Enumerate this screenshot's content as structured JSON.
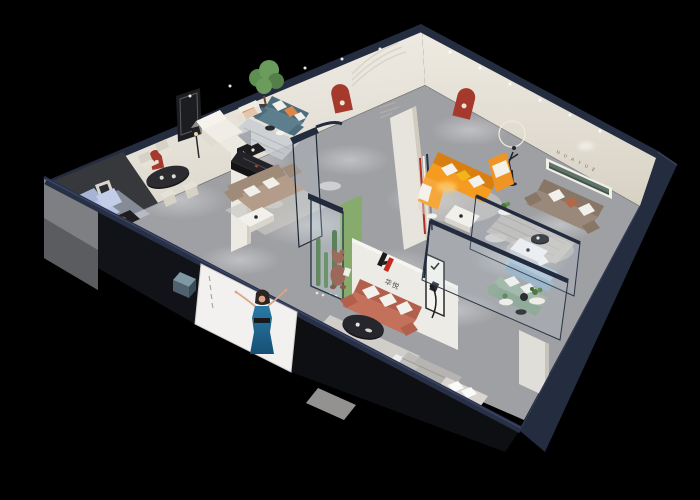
{
  "scene": {
    "type": "isometric-showroom-cutaway-render",
    "background": "#000000",
    "brand": {
      "logo_text": "华悦",
      "wall_letters": "H U A Y U E",
      "logo_black": "#1b1b1b",
      "logo_red": "#c5281c"
    },
    "palette": {
      "floor": "#9fa0a4",
      "wall_cream": "#ebe8e1",
      "wall_cream_dark": "#e0dbd0",
      "wall_navy": "#242c3f",
      "wall_navy_light": "#2c3550",
      "dark_panel": "#37383c",
      "niche_red": "#a4392c",
      "glass": "#cfe2ec",
      "sofa_periwinkle": "#b7c3e0",
      "sofa_teal": "#5d7f8d",
      "sofa_tan": "#b39d8a",
      "sofa_orange": "#f59b20",
      "sofa_taupe": "#9a887b",
      "sofa_blue": "#a9c2d4",
      "sofa_green": "#9cb2a0",
      "sofa_coral": "#c4715c",
      "bed_white": "#e9e8e6",
      "console_black": "#232327",
      "plant_green": "#5e8f52",
      "terrarium_green": "#86ab6d",
      "pillow_orange": "#e08548",
      "pillow_yellow": "#f2b418",
      "poster_dress_blue": "#2a7aa6"
    },
    "rooms": [
      {
        "name": "living-room-periwinkle",
        "items": [
          "periwinkle sofa set",
          "black coffee table",
          "black media console",
          "dark tv feature wall",
          "red arch niche"
        ]
      },
      {
        "name": "dining-area",
        "items": [
          "black oval dining table",
          "four cream chairs",
          "floor lamp"
        ]
      },
      {
        "name": "lounge-teal",
        "items": [
          "teal sofa with orange pillow",
          "cream armchair",
          "potted tree",
          "striped rug",
          "round side tables"
        ]
      },
      {
        "name": "lounge-tan",
        "items": [
          "tan fabric sofa",
          "white coffee table",
          "white corner sofa",
          "black media console"
        ]
      },
      {
        "name": "showroom-orange",
        "items": [
          "orange sectional sofa",
          "warm reading light",
          "white coffee table",
          "striped pillar detail"
        ]
      },
      {
        "name": "lounge-taupe",
        "items": [
          "taupe sofa",
          "runner sculpture with halo ring",
          "recessed green shelf",
          "HUAYUE wall letters",
          "round rug",
          "plant table"
        ]
      },
      {
        "name": "glass-room",
        "items": [
          "light blue sofa",
          "sage green sofa",
          "white coffee table",
          "round side tables",
          "glass partitions"
        ]
      },
      {
        "name": "brand-room",
        "items": [
          "brand logo wall",
          "coral sofa with white cushions",
          "black oval coffee table",
          "white ottoman",
          "display shelf",
          "teddy bear mascot",
          "glass terrarium with cacti"
        ]
      },
      {
        "name": "bedroom",
        "items": [
          "white bed with pillows",
          "striped rug",
          "white wardrobe"
        ]
      },
      {
        "name": "facade",
        "items": [
          "poster of woman in blue dress",
          "navy outer walls",
          "gray side wall",
          "teal ottoman cube"
        ]
      }
    ]
  }
}
